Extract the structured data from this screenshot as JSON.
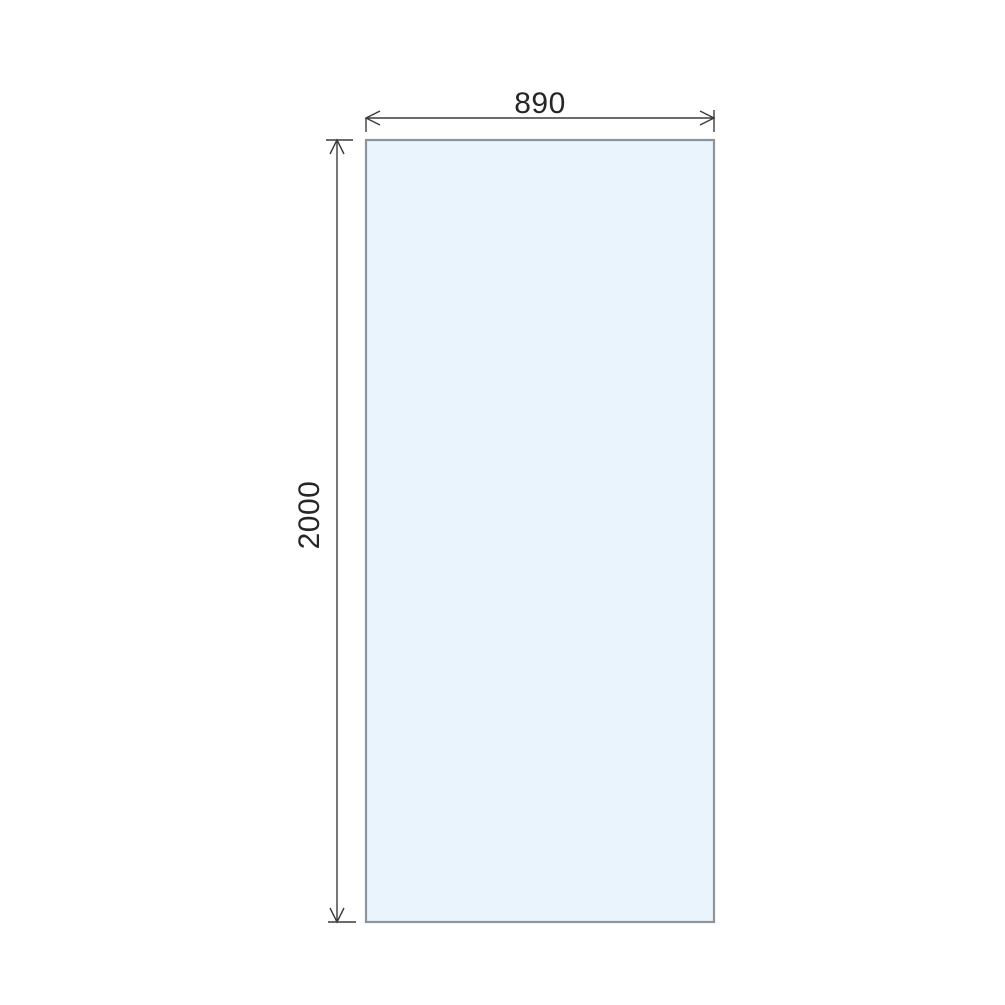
{
  "diagram": {
    "type": "technical-dimension-drawing",
    "subject": "glass panel front elevation",
    "panel": {
      "fill": "#eaf4fd",
      "stroke": "#8d9499"
    },
    "dimensions": {
      "width": {
        "label": "890"
      },
      "height": {
        "label": "2000"
      }
    },
    "line_color": "#3c3c3c",
    "text_color": "#262626",
    "background_color": "#ffffff"
  }
}
